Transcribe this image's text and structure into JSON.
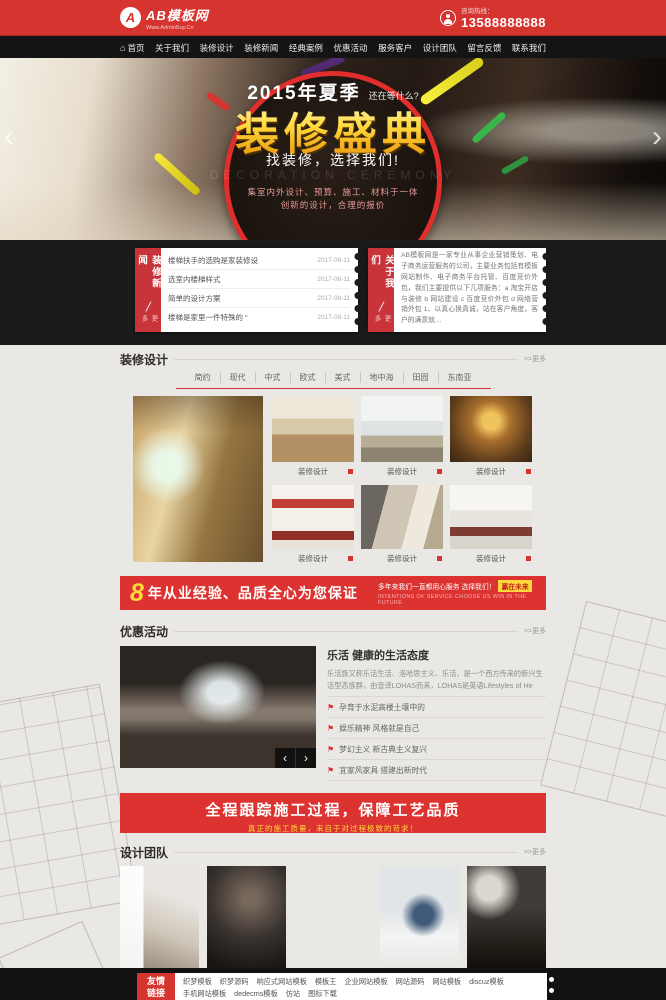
{
  "header": {
    "logo_icon": "A",
    "logo_title": "AB模板网",
    "logo_subtitle": "Www.AdminBuy.Cn",
    "hotline_label": "咨询热线：",
    "hotline_phone": "13588888888"
  },
  "nav": {
    "home_icon": "⌂",
    "items": [
      "首页",
      "关于我们",
      "装修设计",
      "装修新闻",
      "经典案例",
      "优惠活动",
      "服务客户",
      "设计团队",
      "留言反馈",
      "联系我们"
    ]
  },
  "banner": {
    "season": "2015年夏季",
    "tease": "还在等什么?",
    "headline": "装修盛典",
    "slogan": "找装修，选择我们!",
    "watermark": "DECORATION CEREMONY",
    "desc_line1": "集室内外设计、预算、施工、材料于一体",
    "desc_line2": "创新的设计，合理的报价",
    "prev_arrow": "‹",
    "next_arrow": "›"
  },
  "news": {
    "tab_title": "装修新闻",
    "tab_more": "更多",
    "items": [
      {
        "title": "楼梯扶手的选购是家装修设",
        "date": "2017-08-11"
      },
      {
        "title": "选室内楼梯样式",
        "date": "2017-08-11"
      },
      {
        "title": "简单的设计方案",
        "date": "2017-08-11"
      },
      {
        "title": "楼梯是家里一件特殊的 “",
        "date": "2017-08-11"
      }
    ]
  },
  "about": {
    "tab_title": "关于我们",
    "tab_more": "更多",
    "text": "AB模板网是一家专业从事企业营销策划、电子商务运营服务的公司，主要业务包括有模板网站制作、电子商务平台托管、百度竞价外包，我们主要提供以下几项服务：a 淘宝开店与装修 b 网站建设 c 百度竞价外包 d 网络营销外包 1、以真心换真诚，站在客户角度，客户的满意就…"
  },
  "design": {
    "section_title": "装修设计",
    "more": ">>更多",
    "tabs": [
      "简约",
      "现代",
      "中式",
      "欧式",
      "美式",
      "地中海",
      "田园",
      "东南亚"
    ],
    "captions": [
      "装修设计",
      "装修设计",
      "装修设计",
      "装修设计",
      "装修设计",
      "装修设计"
    ]
  },
  "experience_banner": {
    "number": "8",
    "title": "年从业经验、品质全心为您保证",
    "sub1": "多年来我们一直都用心服务 选择我们！",
    "highlight": "赢在未来",
    "sub2": "INTENTIONS OF SERVICE  CHOOSE US WIN IN THE FUTURE"
  },
  "promo": {
    "section_title": "优惠活动",
    "more": ">>更多",
    "article_title": "乐活 健康的生活态度",
    "article_excerpt": "乐活族又称乐活生活、洛哈思主义、乐活，是一个西方传来的新兴生活型态族群，由音译LOHAS而来，LOHAS是英语Lifestyles of He",
    "flag_icon": "⚑",
    "list": [
      "孕育于水泥高楼土壤中的",
      "娱乐精神 风格就是自己",
      "梦幻主义 新古典主义复兴",
      "宜家风家具 搭建出新时代"
    ],
    "prev": "‹",
    "next": "›"
  },
  "quality_banner": {
    "title": "全程跟踪施工过程，保障工艺品质",
    "subtitle": "真正的施工质量，来自于对过程极致的苛求！"
  },
  "team": {
    "section_title": "设计团队",
    "more": ">>更多"
  },
  "footer": {
    "links_label_line1": "友情",
    "links_label_line2": "链接",
    "links": [
      "织梦模板",
      "织梦源码",
      "响应式网站模板",
      "模板王",
      "企业网站模板",
      "网站源码",
      "网站模板",
      "discuz模板",
      "手机网站模板",
      "dedecms模板",
      "仿站",
      "图标下载"
    ]
  },
  "colors": {
    "primary_red": "#d6342f",
    "banner_red": "#dc3230",
    "gold": "#ffd83d",
    "dark": "#1b1b1b",
    "light_bg": "#eae8e5"
  }
}
